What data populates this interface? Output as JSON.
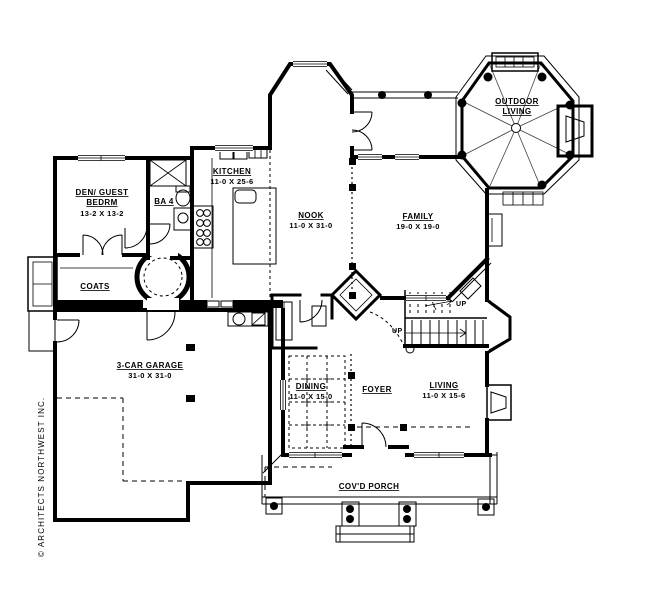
{
  "plan": {
    "copyright": "© ARCHITECTS NORTHWEST INC.",
    "colors": {
      "ink": "#000000",
      "paper": "#ffffff"
    },
    "rooms": {
      "den": {
        "line1": "DEN/ GUEST",
        "line2": "BEDRM",
        "dims": "13-2 X 13-2"
      },
      "bath": {
        "name": "BA 4"
      },
      "coats": {
        "name": "COATS"
      },
      "kitchen": {
        "name": "KITCHEN",
        "dims": "11-0 X 25-6"
      },
      "nook": {
        "name": "NOOK",
        "dims": "11-0 X 31-0"
      },
      "family": {
        "name": "FAMILY",
        "dims": "19-0 X 19-0"
      },
      "outdoor": {
        "line1": "OUTDOOR",
        "line2": "LIVING"
      },
      "garage": {
        "name": "3-CAR GARAGE",
        "dims": "31-0 X 31-0"
      },
      "dining": {
        "name": "DINING",
        "dims": "11-0 X 15-0"
      },
      "foyer": {
        "name": "FOYER"
      },
      "living": {
        "name": "LIVING",
        "dims": "11-0 X 15-6"
      },
      "porch": {
        "name": "COV'D PORCH"
      }
    },
    "stairs": {
      "up1": "UP",
      "up2": "UP"
    }
  }
}
